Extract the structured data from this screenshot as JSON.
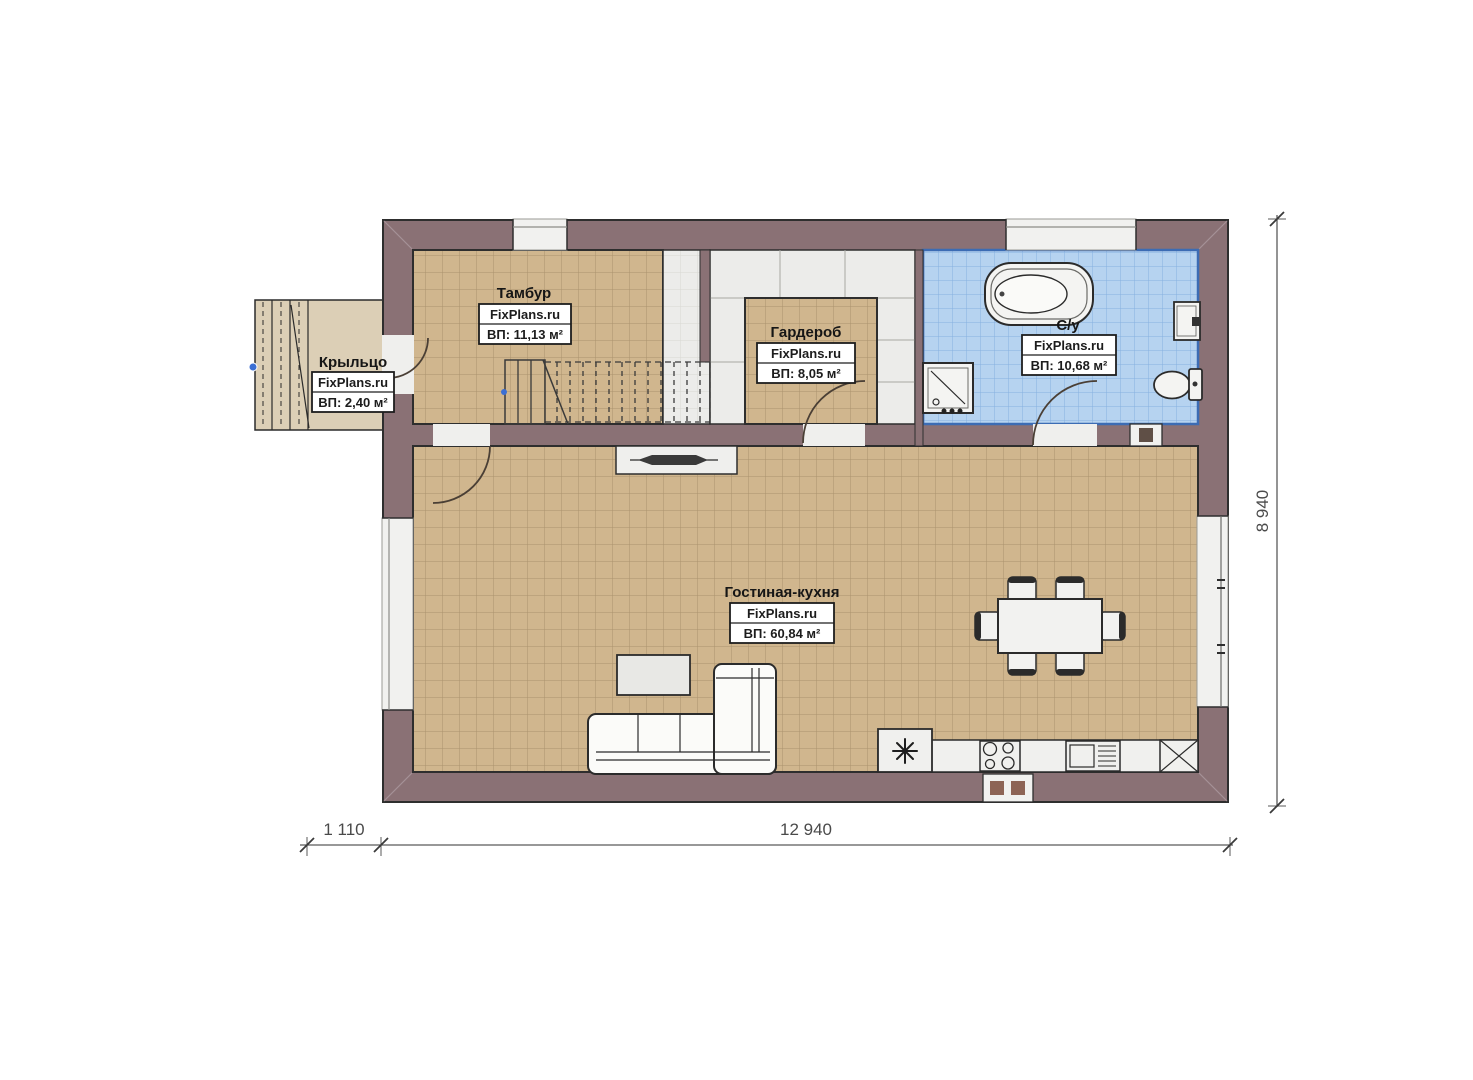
{
  "rooms": {
    "tambur": {
      "name": "Тамбур",
      "watermark": "FixPlans.ru",
      "area": "ВП: 11,13 м²"
    },
    "garderob": {
      "name": "Гардероб",
      "watermark": "FixPlans.ru",
      "area": "ВП: 8,05 м²"
    },
    "su": {
      "name": "С/у",
      "watermark": "FixPlans.ru",
      "area": "ВП: 10,68 м²"
    },
    "gostinaya": {
      "name": "Гостиная-кухня",
      "watermark": "FixPlans.ru",
      "area": "ВП: 60,84 м²"
    },
    "kryltso": {
      "name": "Крыльцо",
      "watermark": "FixPlans.ru",
      "area": "ВП: 2,40 м²"
    }
  },
  "dimensions": {
    "bottom_offset": "1 110",
    "bottom_width": "12 940",
    "right_height": "8 940"
  },
  "symbols": {
    "fridge": "asterisk-star",
    "stove": "four-burners",
    "sink_unit": "basin-with-drainer",
    "corner_cabinet": "x-cross-square",
    "bathtub": "oval-tub",
    "shower": "square-with-diagonal",
    "toilet": "bowl-with-tank",
    "stairs": "treads-with-cut-line"
  },
  "colors": {
    "wall": "#8a7175",
    "tan_tile": "#d0b68e",
    "tan_grid": "#8a7452",
    "blue_tile": "#b6d3f0",
    "blue_grid": "#86b0e0",
    "blue_border": "#3c6cb4",
    "porch_floor": "#dccfb6",
    "white_floor": "#ececea",
    "marker_blue": "#3b6fd4"
  }
}
